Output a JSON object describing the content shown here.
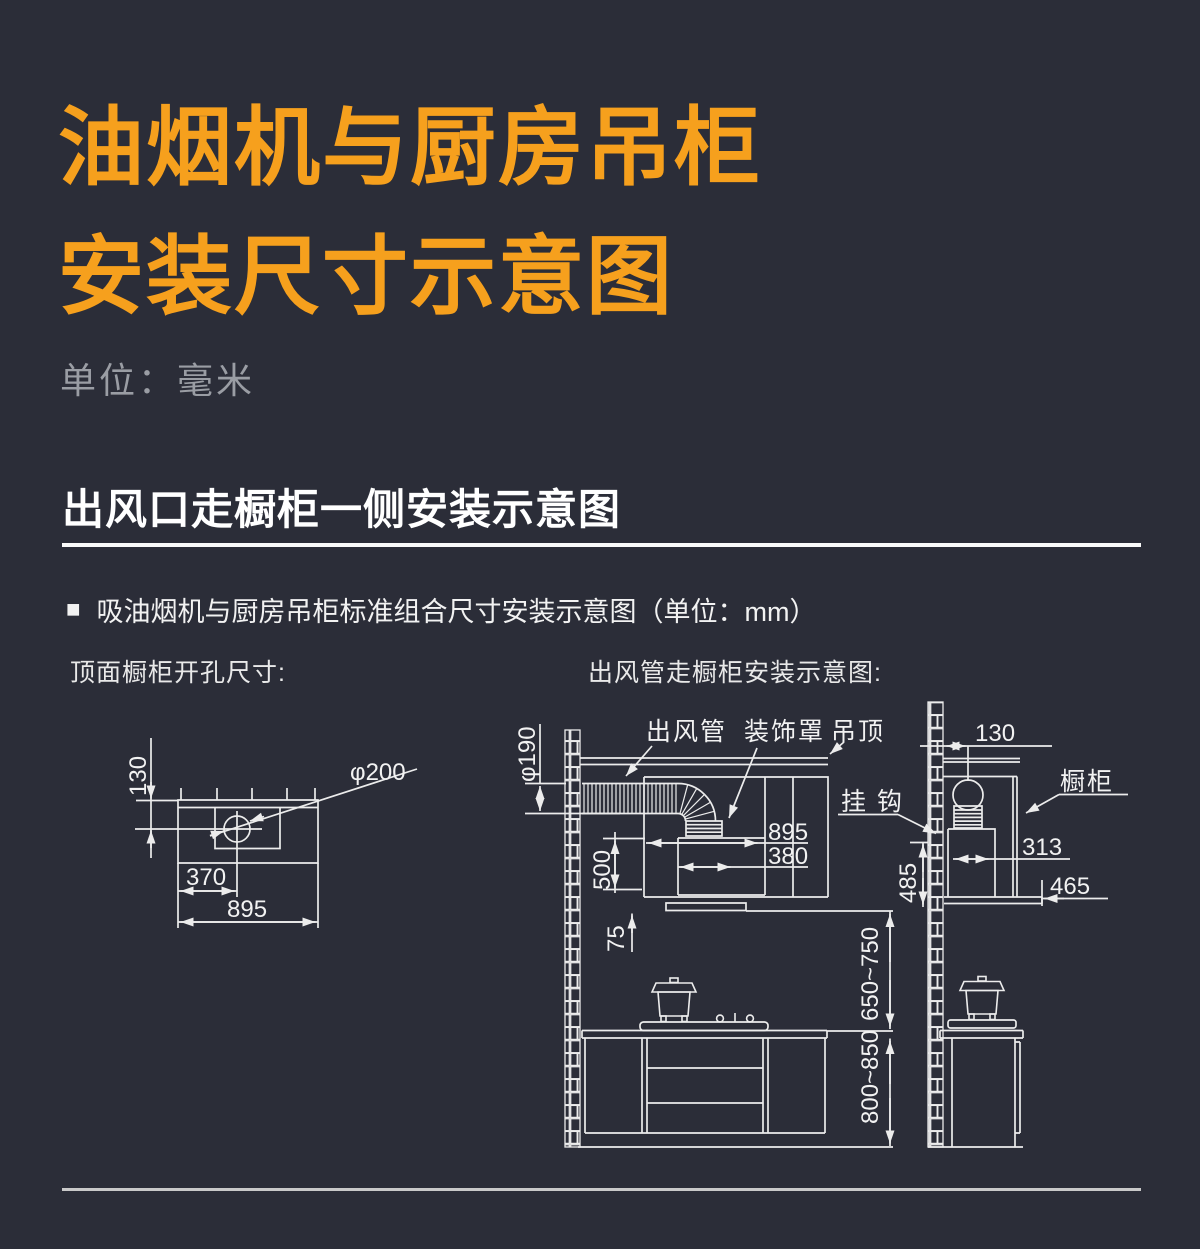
{
  "colors": {
    "background": "#2b2d38",
    "accent_orange": "#f6a01d",
    "muted_gray": "#9a9da4",
    "line_white": "#ececec"
  },
  "title": {
    "line1": "油烟机与厨房吊柜",
    "line2": "安装尺寸示意图"
  },
  "unit_note": "单位：毫米",
  "section": {
    "heading": "出风口走橱柜一侧安装示意图",
    "bullet_marker": "■",
    "subtitle": "吸油烟机与厨房吊柜标准组合尺寸安装示意图（单位：mm）"
  },
  "left_diagram": {
    "label": "顶面橱柜开孔尺寸:",
    "dim_top_offset": "130",
    "dim_hole_diameter": "φ200",
    "dim_hole_center": "370",
    "dim_width": "895"
  },
  "right_diagram": {
    "label": "出风管走橱柜安装示意图:",
    "callout_duct": "出风管",
    "callout_cover": "装饰罩",
    "callout_ceiling": "吊顶",
    "callout_hook": "挂 钩",
    "callout_cabinet": "橱柜",
    "dim_duct_diameter": "φ190",
    "dim_hood_width": "895",
    "dim_flue_width": "380",
    "dim_hood_height": "500",
    "dim_lip_height": "75",
    "dim_hood_to_counter": "650~750",
    "dim_counter_height": "800~850",
    "dim_wall_offset": "130",
    "dim_hood_depth": "313",
    "dim_hook_height": "485",
    "dim_cabinet_depth": "465"
  }
}
